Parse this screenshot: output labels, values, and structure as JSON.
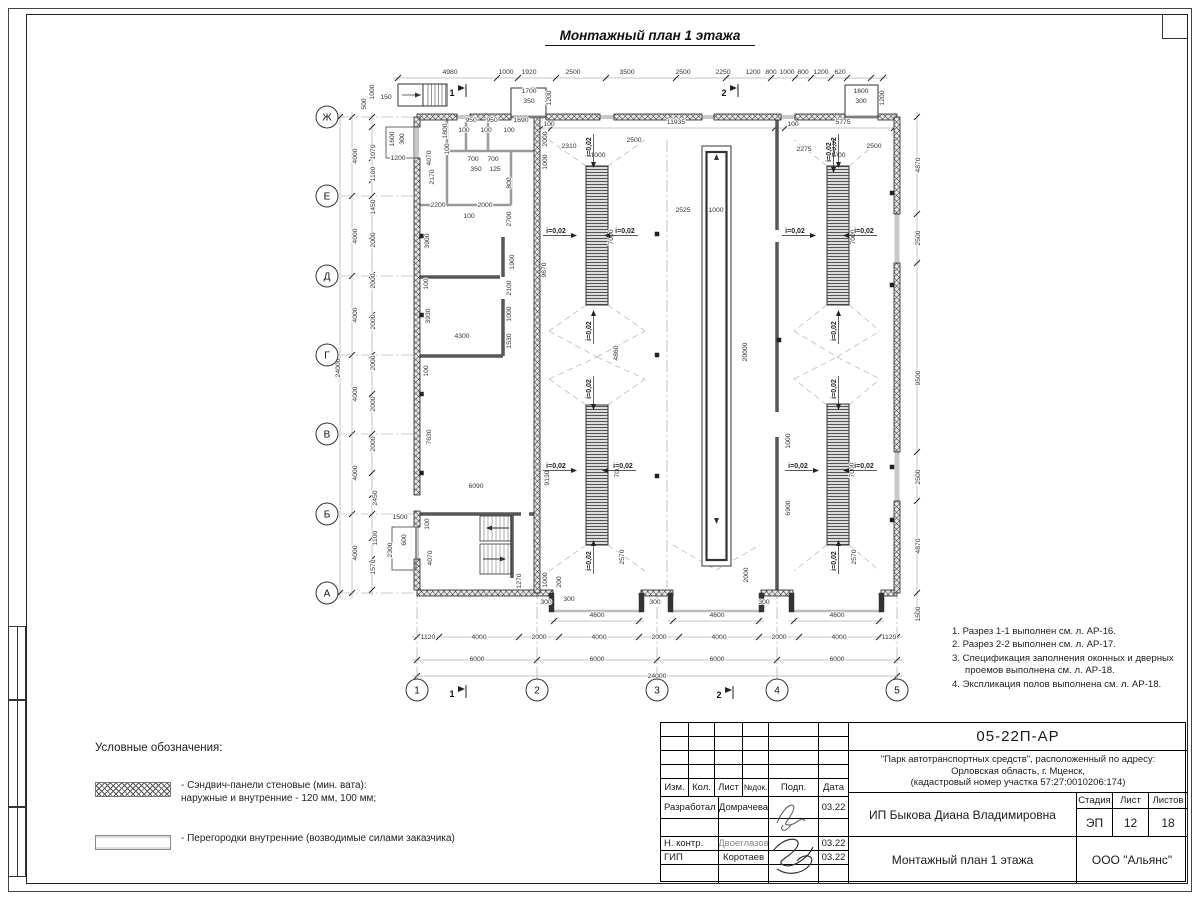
{
  "title": "Монтажный план 1 этажа",
  "plan": {
    "row_axes": [
      "Ж",
      "Е",
      "Д",
      "Г",
      "В",
      "Б",
      "А"
    ],
    "col_axes": [
      "1",
      "2",
      "3",
      "4",
      "5"
    ],
    "slope_label": "i=0,02",
    "section_marks": [
      "1",
      "2",
      "1",
      "2"
    ],
    "dims": [
      {
        "t": "4980",
        "x": 450,
        "y": 74
      },
      {
        "t": "1000",
        "x": 506,
        "y": 74
      },
      {
        "t": "1920",
        "x": 529,
        "y": 74
      },
      {
        "t": "2500",
        "x": 573,
        "y": 74
      },
      {
        "t": "3500",
        "x": 627,
        "y": 74
      },
      {
        "t": "2500",
        "x": 683,
        "y": 74
      },
      {
        "t": "2250",
        "x": 723,
        "y": 74
      },
      {
        "t": "1200",
        "x": 753,
        "y": 74
      },
      {
        "t": "800",
        "x": 771,
        "y": 74
      },
      {
        "t": "1000",
        "x": 787,
        "y": 74
      },
      {
        "t": "800",
        "x": 803,
        "y": 74
      },
      {
        "t": "1200",
        "x": 821,
        "y": 74
      },
      {
        "t": "620",
        "x": 840,
        "y": 74
      },
      {
        "t": "1700",
        "x": 529,
        "y": 93
      },
      {
        "t": "350",
        "x": 529,
        "y": 103
      },
      {
        "t": "1200",
        "x": 551,
        "y": 98,
        "r": 1
      },
      {
        "t": "150",
        "x": 386,
        "y": 99
      },
      {
        "t": "500",
        "x": 366,
        "y": 104,
        "r": 1
      },
      {
        "t": "1000",
        "x": 374,
        "y": 92,
        "r": 1
      },
      {
        "t": "1600",
        "x": 861,
        "y": 93
      },
      {
        "t": "300",
        "x": 861,
        "y": 103
      },
      {
        "t": "1200",
        "x": 884,
        "y": 98,
        "r": 1
      },
      {
        "t": "1600",
        "x": 394,
        "y": 139,
        "r": 1
      },
      {
        "t": "300",
        "x": 404,
        "y": 139,
        "r": 1
      },
      {
        "t": "1200",
        "x": 398,
        "y": 160
      },
      {
        "t": "100",
        "x": 549,
        "y": 126
      },
      {
        "t": "11935",
        "x": 676,
        "y": 124
      },
      {
        "t": "100",
        "x": 793,
        "y": 126
      },
      {
        "t": "5775",
        "x": 843,
        "y": 124
      },
      {
        "t": "2310",
        "x": 569,
        "y": 148
      },
      {
        "t": "2500",
        "x": 634,
        "y": 142
      },
      {
        "t": "1000",
        "x": 598,
        "y": 157
      },
      {
        "t": "2275",
        "x": 804,
        "y": 151
      },
      {
        "t": "2500",
        "x": 874,
        "y": 148
      },
      {
        "t": "1000",
        "x": 838,
        "y": 157
      },
      {
        "t": "2000",
        "x": 547,
        "y": 139,
        "r": 1
      },
      {
        "t": "1000",
        "x": 547,
        "y": 162,
        "r": 1
      },
      {
        "t": "2525",
        "x": 683,
        "y": 212
      },
      {
        "t": "1000",
        "x": 716,
        "y": 212
      },
      {
        "t": "9670",
        "x": 546,
        "y": 270,
        "r": 1
      },
      {
        "t": "7000",
        "x": 613,
        "y": 237,
        "r": 1
      },
      {
        "t": "7000",
        "x": 855,
        "y": 237,
        "r": 1
      },
      {
        "t": "4860",
        "x": 618,
        "y": 353,
        "r": 1
      },
      {
        "t": "20000",
        "x": 747,
        "y": 352,
        "r": 1
      },
      {
        "t": "9130",
        "x": 549,
        "y": 478,
        "r": 1
      },
      {
        "t": "7000",
        "x": 619,
        "y": 470,
        "r": 1
      },
      {
        "t": "7000",
        "x": 854,
        "y": 470,
        "r": 1
      },
      {
        "t": "2570",
        "x": 624,
        "y": 557,
        "r": 1
      },
      {
        "t": "2570",
        "x": 856,
        "y": 557,
        "r": 1
      },
      {
        "t": "2000",
        "x": 748,
        "y": 575,
        "r": 1
      },
      {
        "t": "6900",
        "x": 790,
        "y": 508,
        "r": 1
      },
      {
        "t": "1000",
        "x": 790,
        "y": 441,
        "r": 1
      },
      {
        "t": "4870",
        "x": 920,
        "y": 165,
        "r": 1
      },
      {
        "t": "2500",
        "x": 920,
        "y": 238,
        "r": 1
      },
      {
        "t": "9500",
        "x": 920,
        "y": 378,
        "r": 1
      },
      {
        "t": "2500",
        "x": 920,
        "y": 477,
        "r": 1
      },
      {
        "t": "4870",
        "x": 920,
        "y": 546,
        "r": 1
      },
      {
        "t": "1500",
        "x": 920,
        "y": 614,
        "r": 1
      },
      {
        "t": "24000",
        "x": 340,
        "y": 368,
        "r": 1
      },
      {
        "t": "4000",
        "x": 357,
        "y": 156,
        "r": 1
      },
      {
        "t": "4000",
        "x": 357,
        "y": 236,
        "r": 1
      },
      {
        "t": "4000",
        "x": 357,
        "y": 315,
        "r": 1
      },
      {
        "t": "4000",
        "x": 357,
        "y": 394,
        "r": 1
      },
      {
        "t": "4000",
        "x": 357,
        "y": 473,
        "r": 1
      },
      {
        "t": "4000",
        "x": 357,
        "y": 553,
        "r": 1
      },
      {
        "t": "1070",
        "x": 375,
        "y": 152,
        "r": 1
      },
      {
        "t": "1100",
        "x": 375,
        "y": 174,
        "r": 1
      },
      {
        "t": "1450",
        "x": 375,
        "y": 207,
        "r": 1
      },
      {
        "t": "2000",
        "x": 375,
        "y": 240,
        "r": 1
      },
      {
        "t": "2000",
        "x": 375,
        "y": 281,
        "r": 1
      },
      {
        "t": "2000",
        "x": 375,
        "y": 322,
        "r": 1
      },
      {
        "t": "2000",
        "x": 375,
        "y": 363,
        "r": 1
      },
      {
        "t": "2000",
        "x": 375,
        "y": 404,
        "r": 1
      },
      {
        "t": "2000",
        "x": 375,
        "y": 444,
        "r": 1
      },
      {
        "t": "2450",
        "x": 377,
        "y": 498,
        "r": 1
      },
      {
        "t": "1100",
        "x": 377,
        "y": 538,
        "r": 1
      },
      {
        "t": "1570",
        "x": 375,
        "y": 567,
        "r": 1
      },
      {
        "t": "1500",
        "x": 400,
        "y": 519
      },
      {
        "t": "600",
        "x": 406,
        "y": 540,
        "r": 1
      },
      {
        "t": "2300",
        "x": 392,
        "y": 550,
        "r": 1
      },
      {
        "t": "100",
        "x": 429,
        "y": 524,
        "r": 1
      },
      {
        "t": "4070",
        "x": 432,
        "y": 558,
        "r": 1
      },
      {
        "t": "1270",
        "x": 521,
        "y": 581,
        "r": 1
      },
      {
        "t": "1000",
        "x": 547,
        "y": 580,
        "r": 1
      },
      {
        "t": "200",
        "x": 561,
        "y": 582,
        "r": 1
      },
      {
        "t": "300",
        "x": 569,
        "y": 601
      },
      {
        "t": "950",
        "x": 471,
        "y": 122
      },
      {
        "t": "950",
        "x": 492,
        "y": 122
      },
      {
        "t": "1690",
        "x": 521,
        "y": 122
      },
      {
        "t": "100",
        "x": 464,
        "y": 132
      },
      {
        "t": "100",
        "x": 486,
        "y": 132
      },
      {
        "t": "100",
        "x": 509,
        "y": 132
      },
      {
        "t": "1800",
        "x": 447,
        "y": 131,
        "r": 1
      },
      {
        "t": "100",
        "x": 449,
        "y": 149,
        "r": 1
      },
      {
        "t": "4070",
        "x": 431,
        "y": 158,
        "r": 1
      },
      {
        "t": "2170",
        "x": 434,
        "y": 177,
        "r": 1
      },
      {
        "t": "700",
        "x": 473,
        "y": 161
      },
      {
        "t": "700",
        "x": 493,
        "y": 161
      },
      {
        "t": "350",
        "x": 476,
        "y": 171
      },
      {
        "t": "125",
        "x": 495,
        "y": 171
      },
      {
        "t": "800",
        "x": 511,
        "y": 183,
        "r": 1
      },
      {
        "t": "2700",
        "x": 511,
        "y": 219,
        "r": 1
      },
      {
        "t": "2200",
        "x": 438,
        "y": 207
      },
      {
        "t": "2000",
        "x": 485,
        "y": 207
      },
      {
        "t": "100",
        "x": 469,
        "y": 218
      },
      {
        "t": "3900",
        "x": 429,
        "y": 241,
        "r": 1
      },
      {
        "t": "1900",
        "x": 514,
        "y": 262,
        "r": 1
      },
      {
        "t": "2100",
        "x": 511,
        "y": 288,
        "r": 1
      },
      {
        "t": "1000",
        "x": 511,
        "y": 314,
        "r": 1
      },
      {
        "t": "3930",
        "x": 430,
        "y": 316,
        "r": 1
      },
      {
        "t": "4300",
        "x": 462,
        "y": 338
      },
      {
        "t": "1530",
        "x": 511,
        "y": 341,
        "r": 1
      },
      {
        "t": "100",
        "x": 428,
        "y": 284,
        "r": 1
      },
      {
        "t": "100",
        "x": 428,
        "y": 371,
        "r": 1
      },
      {
        "t": "7630",
        "x": 431,
        "y": 437,
        "r": 1
      },
      {
        "t": "6090",
        "x": 476,
        "y": 488
      },
      {
        "t": "300",
        "x": 546,
        "y": 604
      },
      {
        "t": "300",
        "x": 655,
        "y": 604
      },
      {
        "t": "300",
        "x": 764,
        "y": 604
      },
      {
        "t": "4600",
        "x": 597,
        "y": 617
      },
      {
        "t": "4600",
        "x": 717,
        "y": 617
      },
      {
        "t": "4600",
        "x": 837,
        "y": 617
      },
      {
        "t": "1120",
        "x": 428,
        "y": 639
      },
      {
        "t": "4000",
        "x": 479,
        "y": 639
      },
      {
        "t": "2000",
        "x": 539,
        "y": 639
      },
      {
        "t": "4000",
        "x": 599,
        "y": 639
      },
      {
        "t": "2000",
        "x": 659,
        "y": 639
      },
      {
        "t": "4000",
        "x": 719,
        "y": 639
      },
      {
        "t": "2000",
        "x": 779,
        "y": 639
      },
      {
        "t": "4000",
        "x": 839,
        "y": 639
      },
      {
        "t": "1120",
        "x": 889,
        "y": 639
      },
      {
        "t": "6000",
        "x": 477,
        "y": 661
      },
      {
        "t": "6000",
        "x": 597,
        "y": 661
      },
      {
        "t": "6000",
        "x": 717,
        "y": 661
      },
      {
        "t": "6000",
        "x": 837,
        "y": 661
      },
      {
        "t": "24000",
        "x": 657,
        "y": 678
      }
    ]
  },
  "notes": [
    "1. Разрез 1-1 выполнен см. л. АР-16.",
    "2. Разрез 2-2 выполнен см. л. АР-17.",
    "3. Спецификация заполнения оконных и дверных проемов выполнена см. л. АР-18.",
    "4. Экспликация полов выполнена см. л. АР-18."
  ],
  "legend": {
    "heading": "Условные обозначения:",
    "items": [
      {
        "swatch": "cross",
        "text": "- Сэндвич-панели стеновые (мин. вата):\nнаружные и внутренние - 120 мм, 100 мм;"
      },
      {
        "swatch": "plain",
        "text": "- Перегородки внутренние (возводимые силами заказчика)"
      }
    ]
  },
  "titleblock": {
    "doc_number": "05-22П-АР",
    "project": "\"Парк автотранспортных средств\",  расположенный по адресу:\nОрловская область, г. Мценск,\n(кадастровый номер участка 57:27:0010206:174)",
    "columns": [
      "Изм.",
      "Кол.",
      "Лист",
      "№док.",
      "Подп.",
      "Дата"
    ],
    "rows": [
      {
        "role": "Разработал",
        "name": "Домрачева",
        "date": "03.22"
      },
      {
        "role": "Н. контр.",
        "name": "Двоеглазов",
        "date": "03.22"
      },
      {
        "role": "ГИП",
        "name": "Коротаев",
        "date": "03.22"
      }
    ],
    "client": "ИП Быкова Диана Владимировна",
    "stage_label": "Стадия",
    "sheet_label": "Лист",
    "sheets_label": "Листов",
    "stage": "ЭП",
    "sheet": "12",
    "sheets": "18",
    "drawing_title": "Монтажный план 1 этажа",
    "company": "ООО \"Альянс\""
  }
}
